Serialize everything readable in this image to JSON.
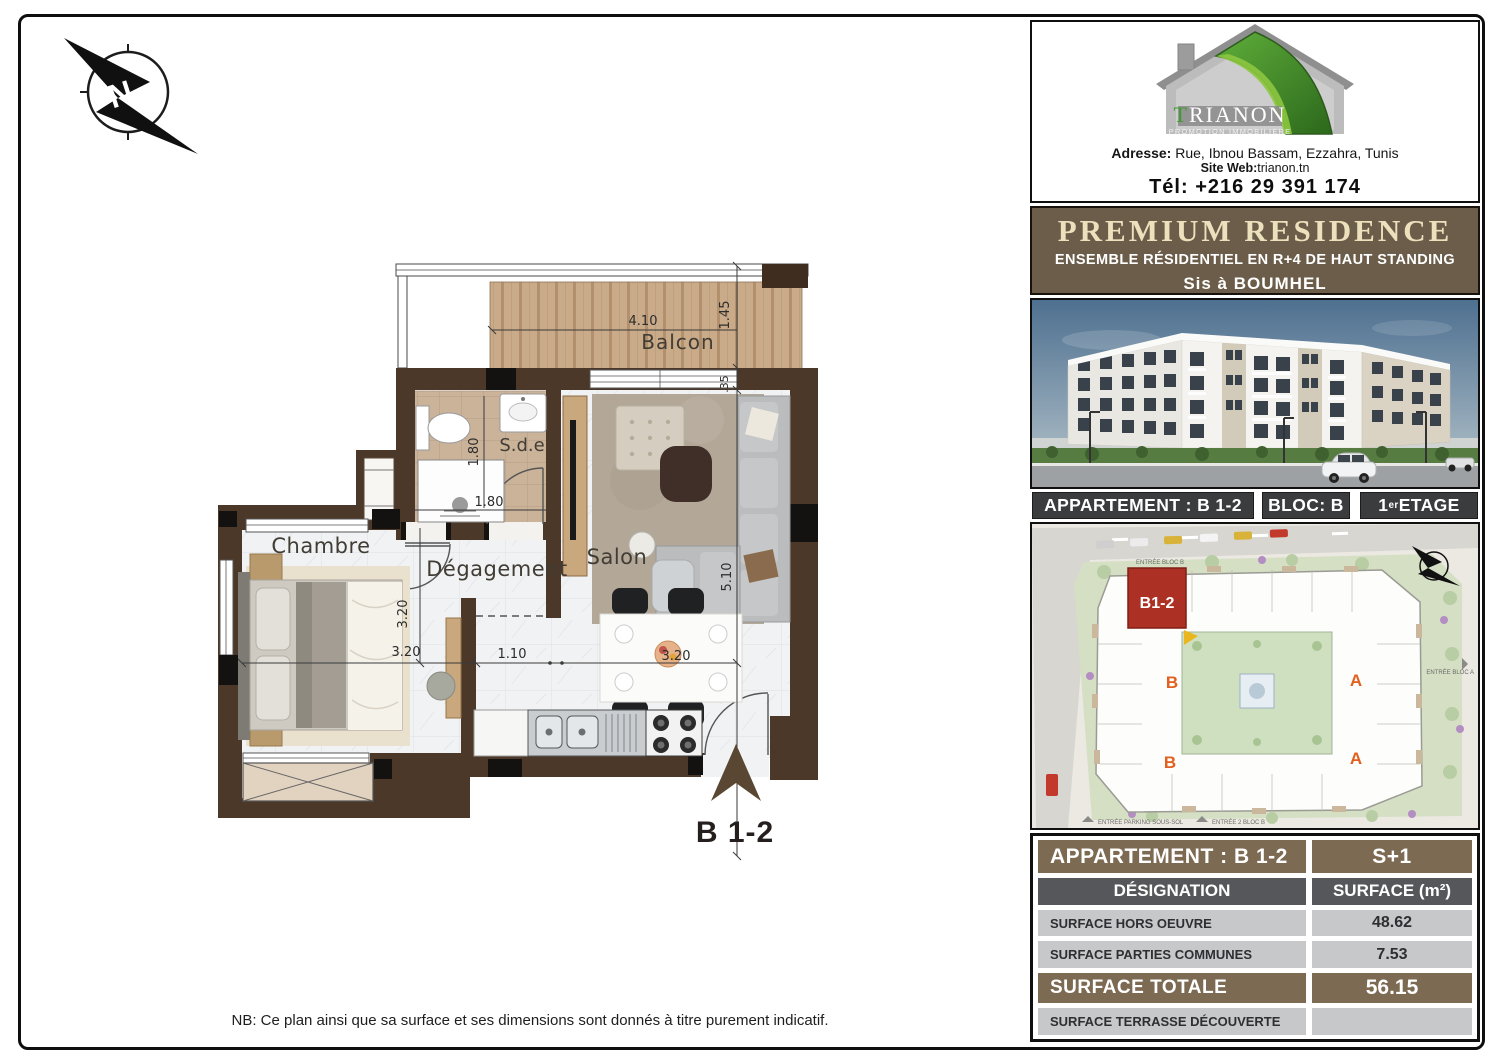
{
  "company": {
    "name_t": "T",
    "name_rest": "RIANON",
    "tagline": "PROMOTION IMMOBILIERE",
    "adresse_label": "Adresse:",
    "adresse_value": " Rue, Ibnou Bassam, Ezzahra, Tunis",
    "site_label": "Site Web:",
    "site_value": "trianon.tn",
    "tel": "Tél: +216  29 391 174"
  },
  "banner": {
    "title": "PREMIUM RESIDENCE",
    "subtitle": "ENSEMBLE RÉSIDENTIEL EN  R+4 DE HAUT STANDING",
    "location": "Sis à  BOUMHEL"
  },
  "bar": {
    "appartement": "APPARTEMENT : B 1-2",
    "bloc": "BLOC: B",
    "etage_num": "1",
    "etage_sup": "er",
    "etage_word": " ETAGE"
  },
  "plan": {
    "labels": {
      "balcon": "Balcon",
      "sde": "S.d.e",
      "chambre": "Chambre",
      "degagement": "Dégagement",
      "salon": "Salon",
      "unit": "B 1-2"
    },
    "dims": {
      "balcon_w": "4.10",
      "balcon_d": "1.45",
      "offset": ".35",
      "sde_h": "1.80",
      "sde_w": "1.80",
      "chambre_h": "3.20",
      "chambre_w": "3.20",
      "hall": "1.10",
      "dining": "3.20",
      "salon_h": "5.10"
    }
  },
  "siteplan": {
    "unit": "B1-2",
    "bloc_b1": "B",
    "bloc_b2": "B",
    "bloc_a1": "A",
    "bloc_a2": "A",
    "entree_bloc_b": "ENTRÉE BLOC B",
    "entree_bloc_a": "ENTRÉE BLOC A",
    "entree_parking": "ENTRÉE PARKING SOUS-SOL",
    "entree_2_bloc_b": "ENTRÉE 2 BLOC B"
  },
  "table": {
    "title_left": "APPARTEMENT : B 1-2",
    "title_right": "S+1",
    "col_designation": "DÉSIGNATION",
    "col_surface": "SURFACE (m²)",
    "rows": [
      {
        "label": "SURFACE HORS OEUVRE",
        "value": "48.62"
      },
      {
        "label": "SURFACE PARTIES COMMUNES",
        "value": "7.53"
      }
    ],
    "total_label": "SURFACE TOTALE",
    "total_value": "56.15",
    "terrasse_label": "SURFACE TERRASSE DÉCOUVERTE",
    "terrasse_value": ""
  },
  "note": "NB: Ce plan ainsi que sa surface et ses dimensions sont donnés à titre purement indicatif."
}
